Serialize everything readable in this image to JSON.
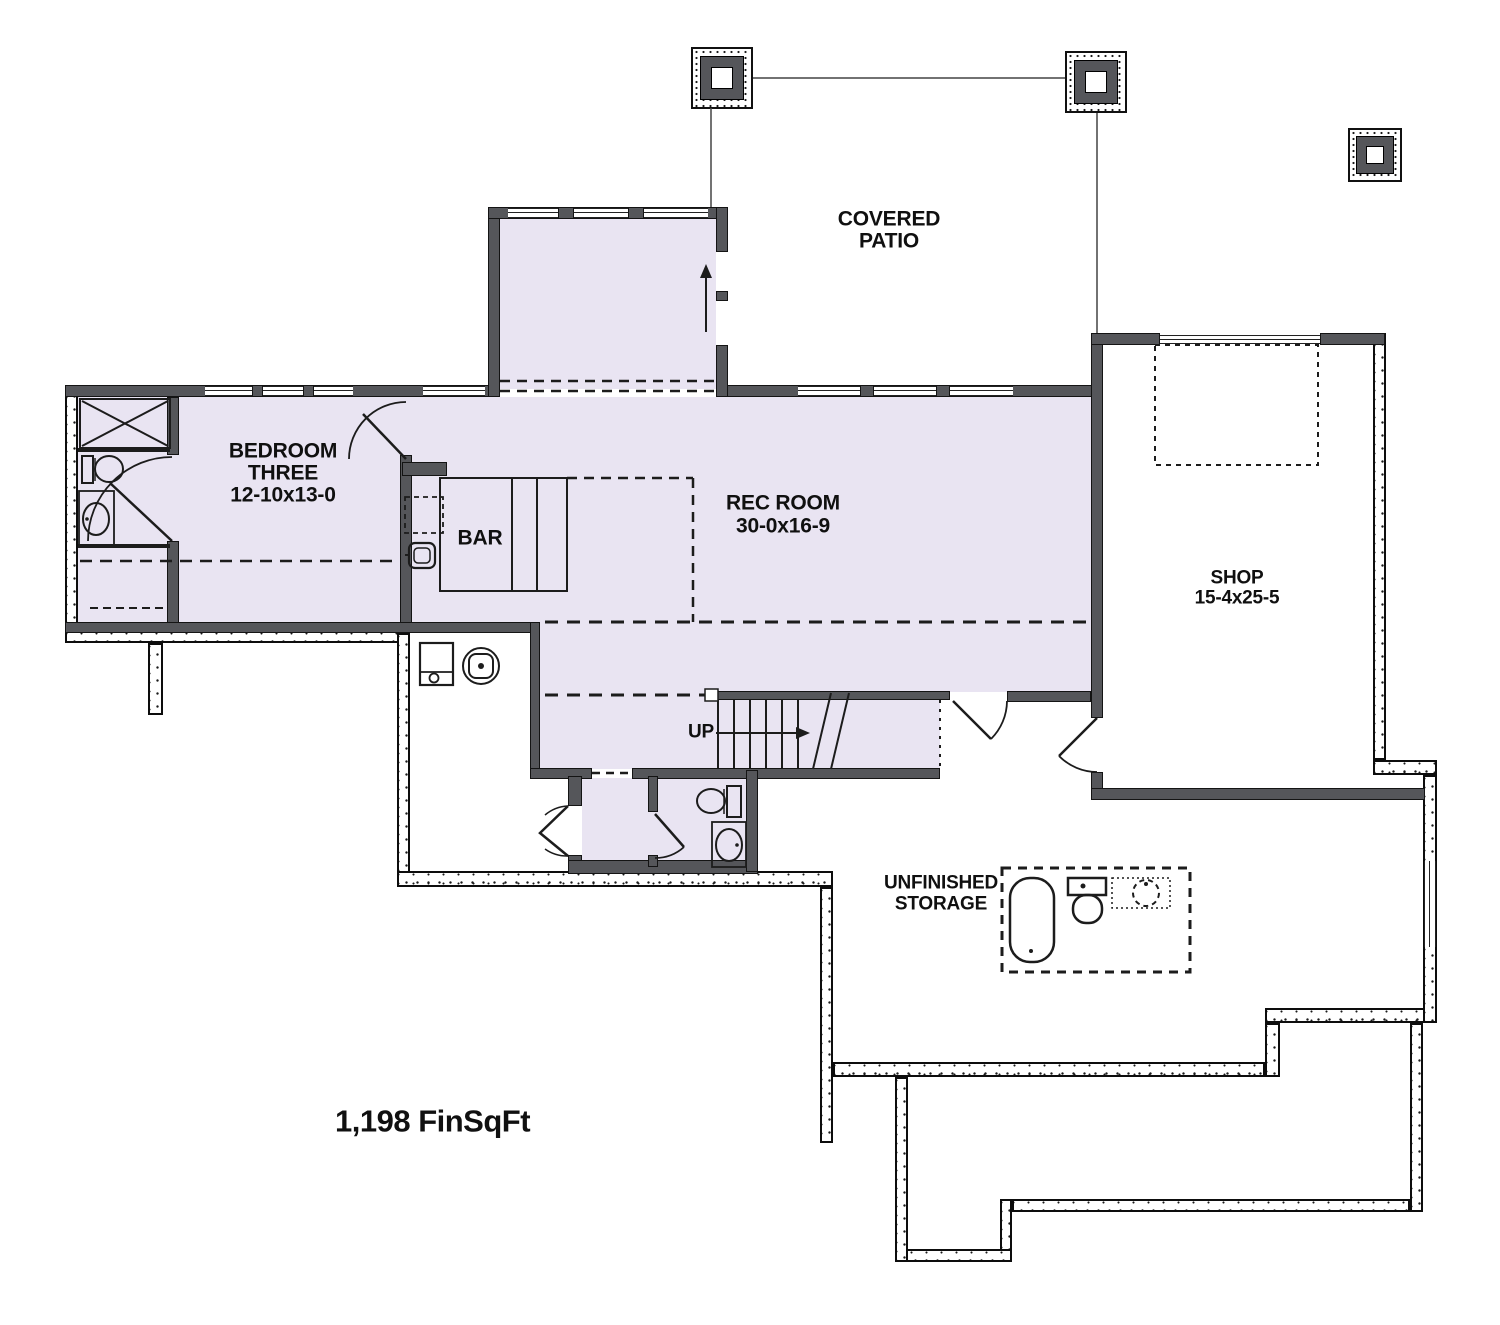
{
  "floor_plan": {
    "covered_patio": {
      "line1": "COVERED",
      "line2": "PATIO"
    },
    "bedroom_three": {
      "line1": "BEDROOM",
      "line2": "THREE",
      "dims": "12-10x13-0"
    },
    "rec_room": {
      "name": "REC ROOM",
      "dims": "30-0x16-9"
    },
    "bar": {
      "name": "BAR"
    },
    "shop": {
      "name": "SHOP",
      "dims": "15-4x25-5"
    },
    "unfinished_storage": {
      "line1": "UNFINISHED",
      "line2": "STORAGE"
    },
    "stairs": {
      "direction": "UP"
    },
    "area_label": "1,198 FinSqFt",
    "colors": {
      "finished_fill": "#e9e4f2",
      "wall_gray": "#55565a",
      "line": "#1c1c1c"
    }
  }
}
